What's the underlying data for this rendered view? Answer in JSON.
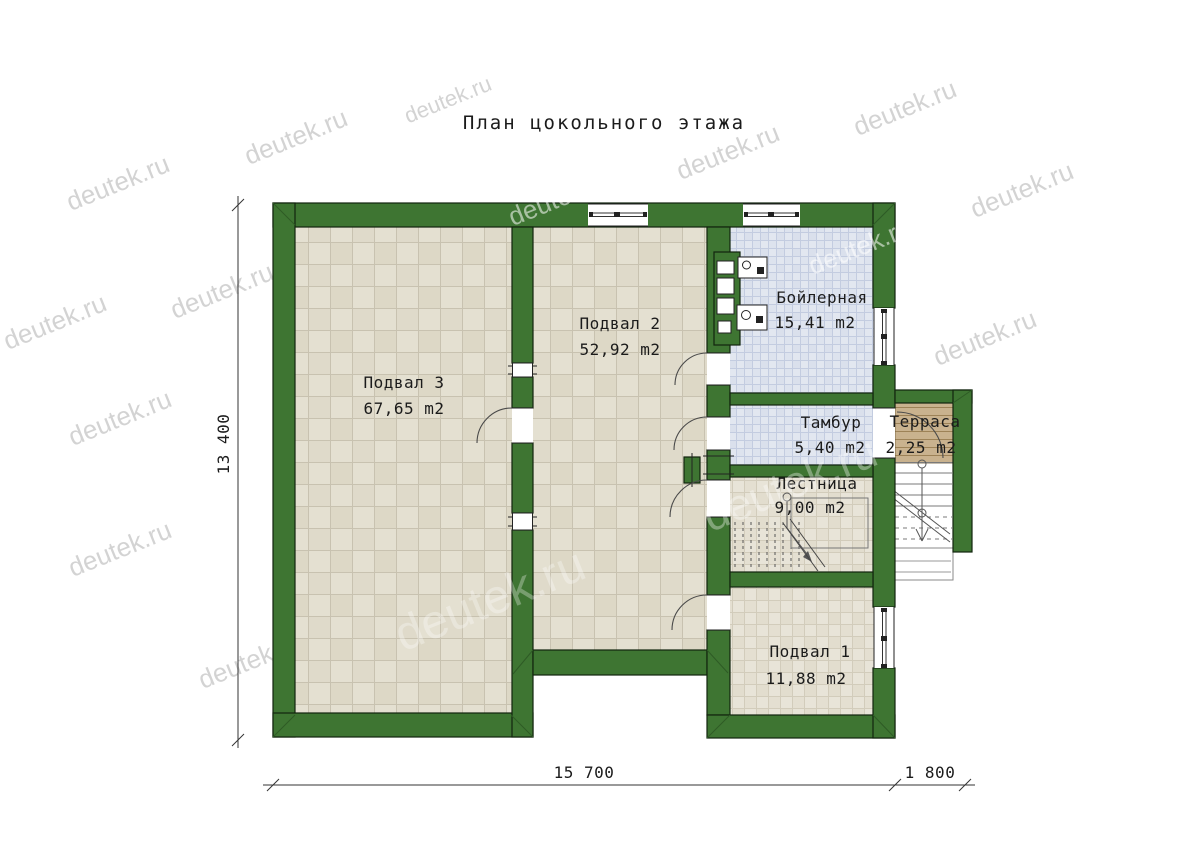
{
  "title": "План цокольного этажа",
  "watermark": {
    "text": "deutek.ru"
  },
  "rooms": {
    "podval3": {
      "name": "Подвал 3",
      "area": "67,65 m2"
    },
    "podval2": {
      "name": "Подвал 2",
      "area": "52,92 m2"
    },
    "boiler": {
      "name": "Бойлерная",
      "area": "15,41 m2"
    },
    "tambur": {
      "name": "Тамбур",
      "area": "5,40 m2"
    },
    "stairs": {
      "name": "Лестница",
      "area": "9,00 m2"
    },
    "podval1": {
      "name": "Подвал 1",
      "area": "11,88 m2"
    },
    "terrace": {
      "name": "Терраса",
      "area": "2,25 m2"
    }
  },
  "dimensions": {
    "height_total": "13 400",
    "width_main": "15 700",
    "width_terrace": "1 800"
  },
  "colors": {
    "wall_green": "#3e7532",
    "floor_beige": "#e4e0d1",
    "floor_blue": "#e2e7f0",
    "terrace_wood": "#c9b28e"
  }
}
